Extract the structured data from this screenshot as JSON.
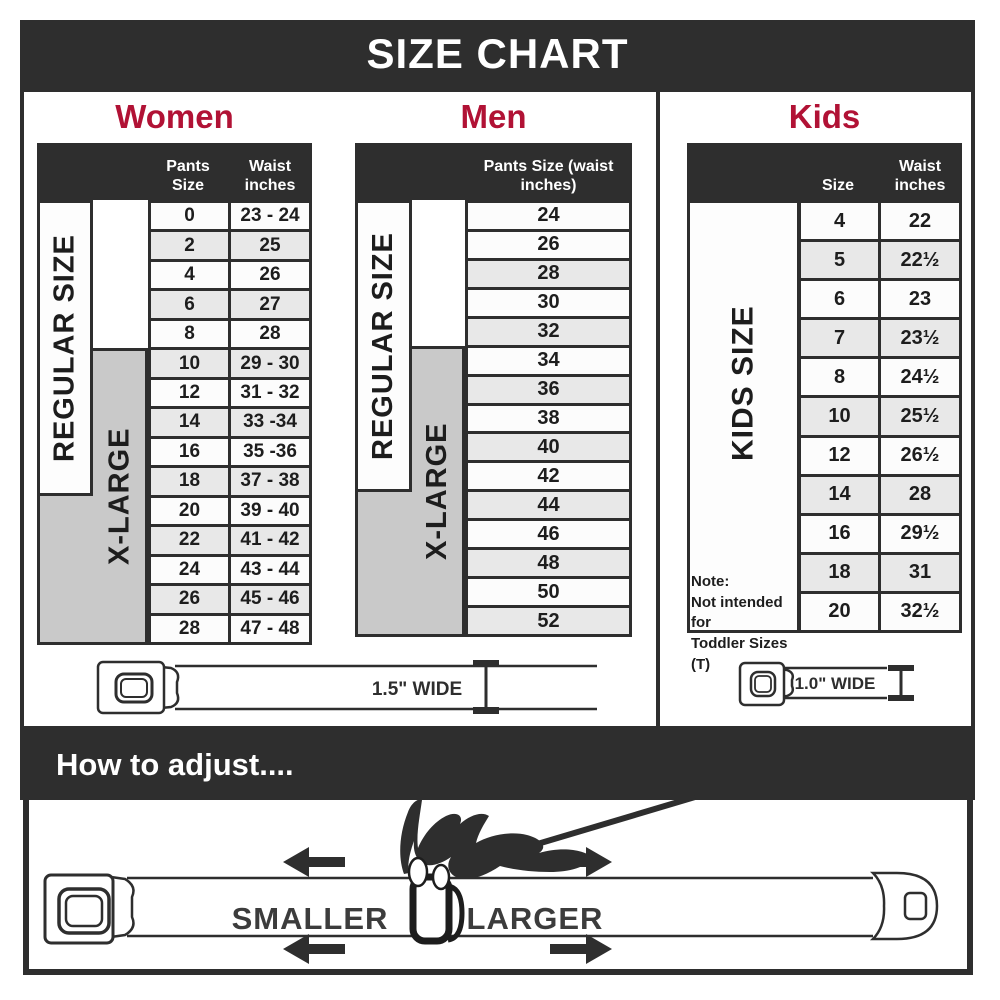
{
  "title": "SIZE CHART",
  "colors": {
    "dark": "#2e2e2e",
    "accent": "#b11235",
    "row_shaded": "#e8e8e8",
    "gray_box": "#c9c9c9"
  },
  "sections": {
    "women": {
      "label": "Women",
      "col1_header": "Pants Size",
      "col2_header": "Waist inches",
      "regular_label": "REGULAR SIZE",
      "xlarge_label": "X-LARGE",
      "rows": [
        [
          "0",
          "23 - 24"
        ],
        [
          "2",
          "25"
        ],
        [
          "4",
          "26"
        ],
        [
          "6",
          "27"
        ],
        [
          "8",
          "28"
        ],
        [
          "10",
          "29 - 30"
        ],
        [
          "12",
          "31 - 32"
        ],
        [
          "14",
          "33 -34"
        ],
        [
          "16",
          "35 -36"
        ],
        [
          "18",
          "37 - 38"
        ],
        [
          "20",
          "39 - 40"
        ],
        [
          "22",
          "41 - 42"
        ],
        [
          "24",
          "43 - 44"
        ],
        [
          "26",
          "45 - 46"
        ],
        [
          "28",
          "47 - 48"
        ]
      ],
      "belt_width_label": "1.5\" WIDE"
    },
    "men": {
      "label": "Men",
      "col_header": "Pants Size (waist inches)",
      "regular_label": "REGULAR SIZE",
      "xlarge_label": "X-LARGE",
      "rows": [
        "24",
        "26",
        "28",
        "30",
        "32",
        "34",
        "36",
        "38",
        "40",
        "42",
        "44",
        "46",
        "48",
        "50",
        "52"
      ]
    },
    "kids": {
      "label": "Kids",
      "col1_header": "Size",
      "col2_header": "Waist inches",
      "side_label": "KIDS SIZE",
      "note": [
        "Note:",
        "Not intended for",
        "Toddler Sizes (T)"
      ],
      "rows": [
        [
          "4",
          "22"
        ],
        [
          "5",
          "22½"
        ],
        [
          "6",
          "23"
        ],
        [
          "7",
          "23½"
        ],
        [
          "8",
          "24½"
        ],
        [
          "10",
          "25½"
        ],
        [
          "12",
          "26½"
        ],
        [
          "14",
          "28"
        ],
        [
          "16",
          "29½"
        ],
        [
          "18",
          "31"
        ],
        [
          "20",
          "32½"
        ]
      ],
      "belt_width_label": "1.0\" WIDE"
    }
  },
  "adjust": {
    "heading": "How to adjust....",
    "smaller_label": "SMALLER",
    "larger_label": "LARGER"
  }
}
